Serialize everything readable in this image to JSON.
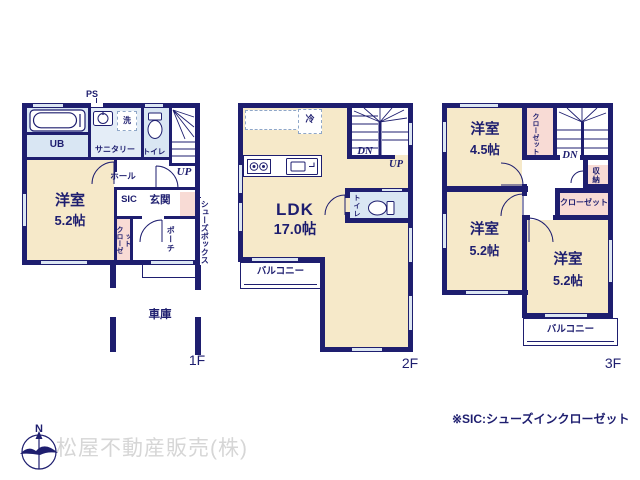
{
  "colors": {
    "wall_navy": "#1e1e6f",
    "room_cream": "#f6e9c9",
    "wet_area_blue": "#d9e6f3",
    "closet_pink": "#f8dbd5",
    "window_blue": "#dce6f2",
    "company_gray": "#d6d6d6"
  },
  "floor1": {
    "floor_label": "1F",
    "ps_label": "PS",
    "ub_label": "UB",
    "sanitary_label": "サニタリー",
    "laundry_label": "洗",
    "toilet_label": "トイレ",
    "up_label": "UP",
    "hall_label": "ホール",
    "room_name": "洋室",
    "room_size": "5.2帖",
    "sic_label": "SIC",
    "entrance_label": "玄関",
    "closet_label": "クローゼット",
    "shoebox_label": "シューズボックス",
    "porch_label": "ポーチ",
    "garage_label": "車庫"
  },
  "floor2": {
    "floor_label": "2F",
    "fridge_label": "冷",
    "dn_label": "DN",
    "up_label": "UP",
    "toilet_label": "トイレ",
    "ldk_name": "LDK",
    "ldk_size": "17.0帖",
    "balcony_label": "バルコニー"
  },
  "floor3": {
    "floor_label": "3F",
    "room1_name": "洋室",
    "room1_size": "4.5帖",
    "closet_side_label": "クローゼット",
    "dn_label": "DN",
    "storage_label": "収納",
    "closet_label": "クローゼット",
    "room2_name": "洋室",
    "room2_size": "5.2帖",
    "room3_name": "洋室",
    "room3_size": "5.2帖",
    "balcony_label": "バルコニー"
  },
  "footer": {
    "compass_n": "N",
    "company_name": "松屋不動産販売(株)",
    "sic_note": "※SIC:シューズインクローゼット"
  }
}
